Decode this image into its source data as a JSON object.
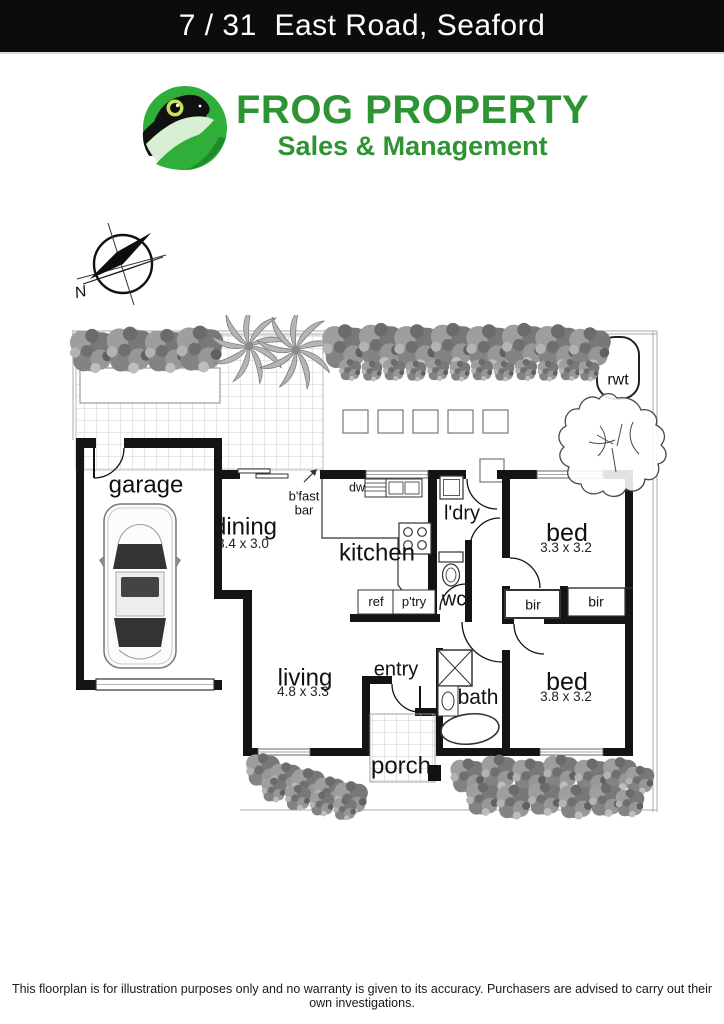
{
  "header": {
    "title": "7 / 31  East Road, Seaford"
  },
  "logo": {
    "line1": "FROG PROPERTY",
    "line2": "Sales & Management",
    "text_green": "#2e9332",
    "circle_green": "#2fae39"
  },
  "compass": {
    "north_label": "N"
  },
  "floorplan": {
    "garage": {
      "label": "garage"
    },
    "dining": {
      "label": "dining",
      "dims": "3.4 x 3.0"
    },
    "kitchen": {
      "label": "kitchen"
    },
    "living": {
      "label": "living",
      "dims": "4.8 x 3.3"
    },
    "bed_front": {
      "label": "bed",
      "dims": "3.3 x 3.2"
    },
    "bed_rear": {
      "label": "bed",
      "dims": "3.8 x 3.2"
    },
    "bath": {
      "label": "bath"
    },
    "laundry": {
      "label": "l'dry"
    },
    "wc": {
      "label": "wc"
    },
    "entry": {
      "label": "entry"
    },
    "porch": {
      "label": "porch"
    },
    "bfast_bar": {
      "line1": "b'fast",
      "line2": "bar"
    },
    "appliances": {
      "dw": "dw",
      "ref": "ref",
      "pantry": "p'try"
    },
    "robes": {
      "left": "bir",
      "right": "bir"
    },
    "rainwater_tank": {
      "label": "rwt"
    }
  },
  "footer": {
    "disclaimer": "This floorplan is for illustration purposes only and no warranty is given to its accuracy. Purchasers are advised to carry out their own investigations."
  }
}
